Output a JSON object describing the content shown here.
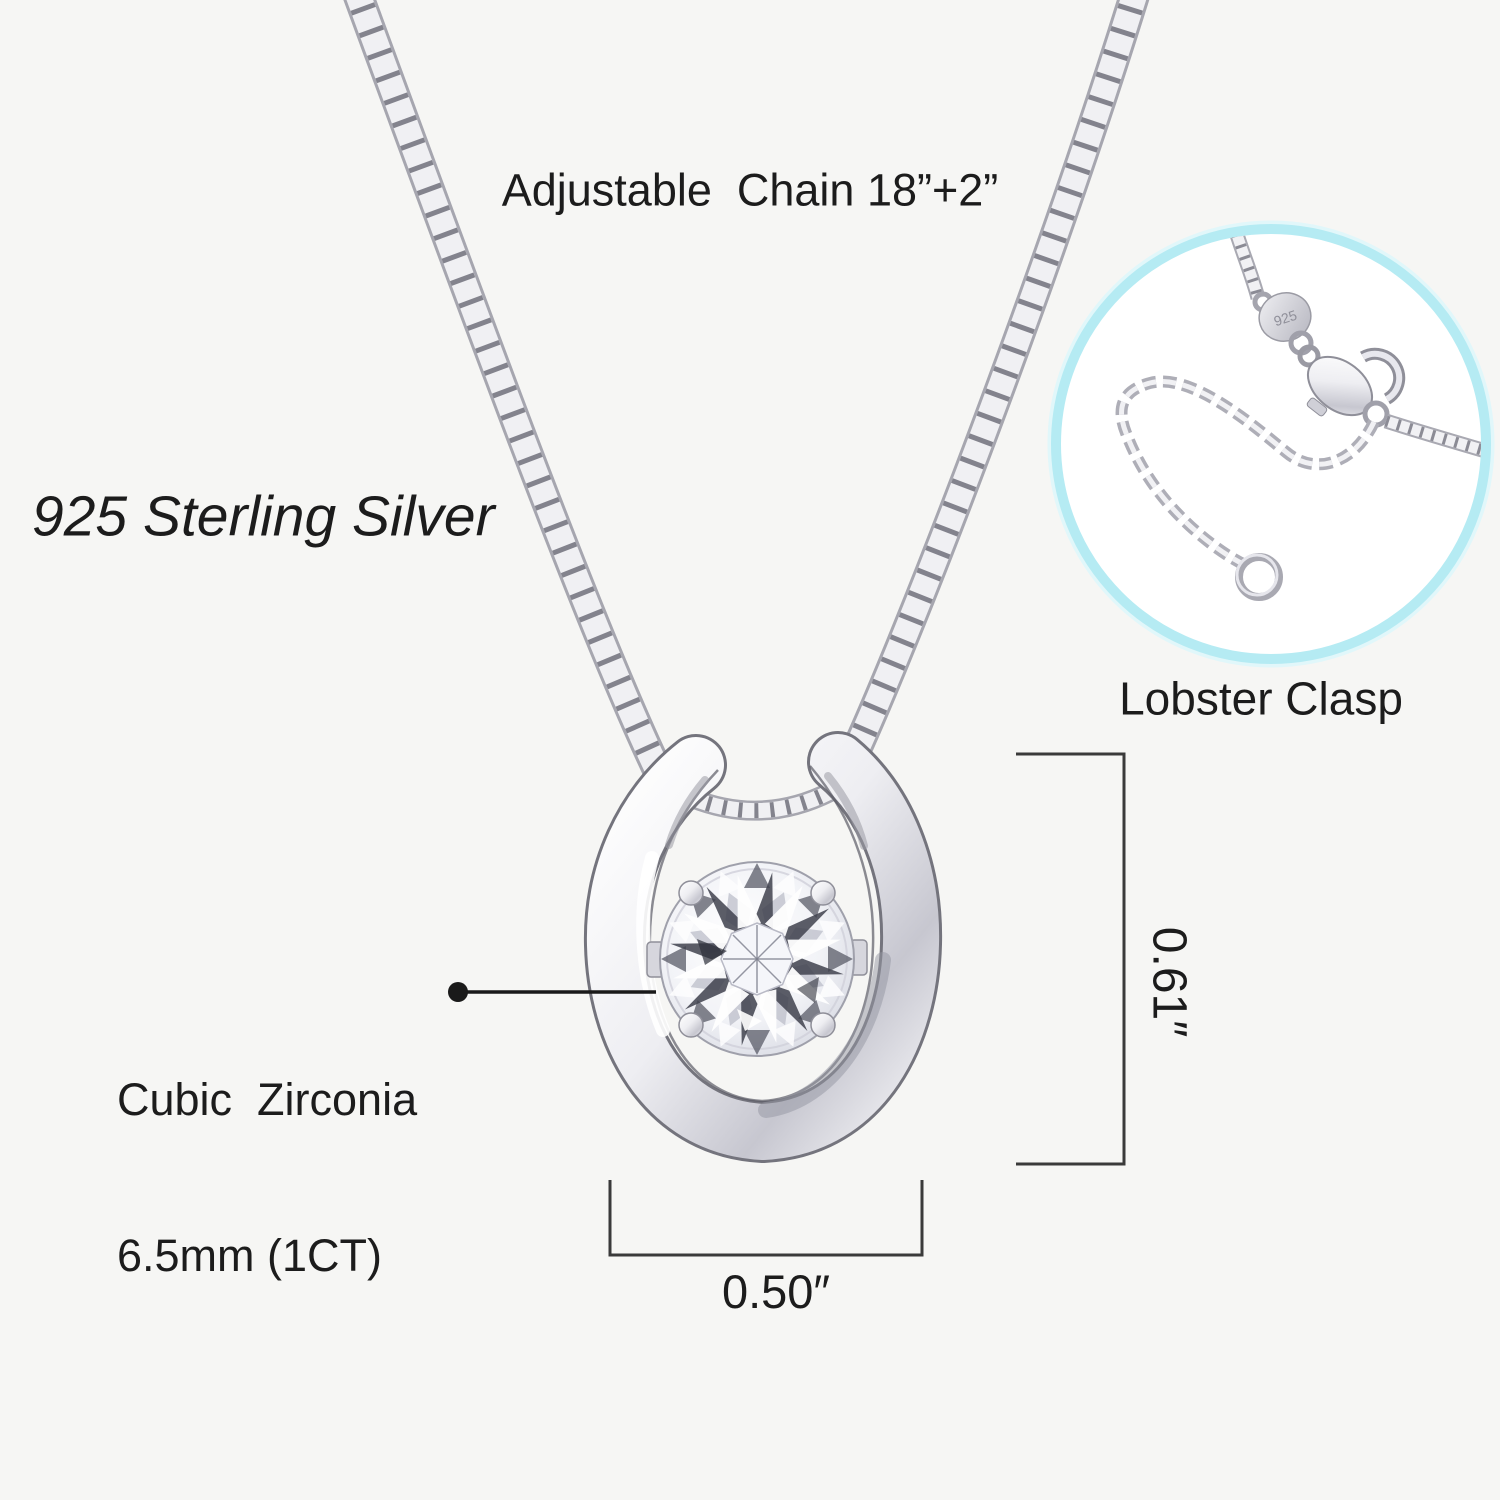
{
  "labels": {
    "chain": "Adjustable  Chain 18”+2”",
    "material": "925 Sterling Silver",
    "clasp": "Lobster Clasp",
    "stone_line1": "Cubic  Zirconia",
    "stone_line2": "6.5mm (1CT)",
    "height": "0.61″",
    "width": "0.50″",
    "tag_stamp": "925"
  },
  "colors": {
    "background": "#f6f6f4",
    "text": "#1c1c1c",
    "measure_line": "#3a3a3a",
    "inset_border": "#b5ebf3",
    "silver_light": "#f2f2f5",
    "silver_mid": "#c6c6cf",
    "silver_dark": "#8a8a94"
  }
}
